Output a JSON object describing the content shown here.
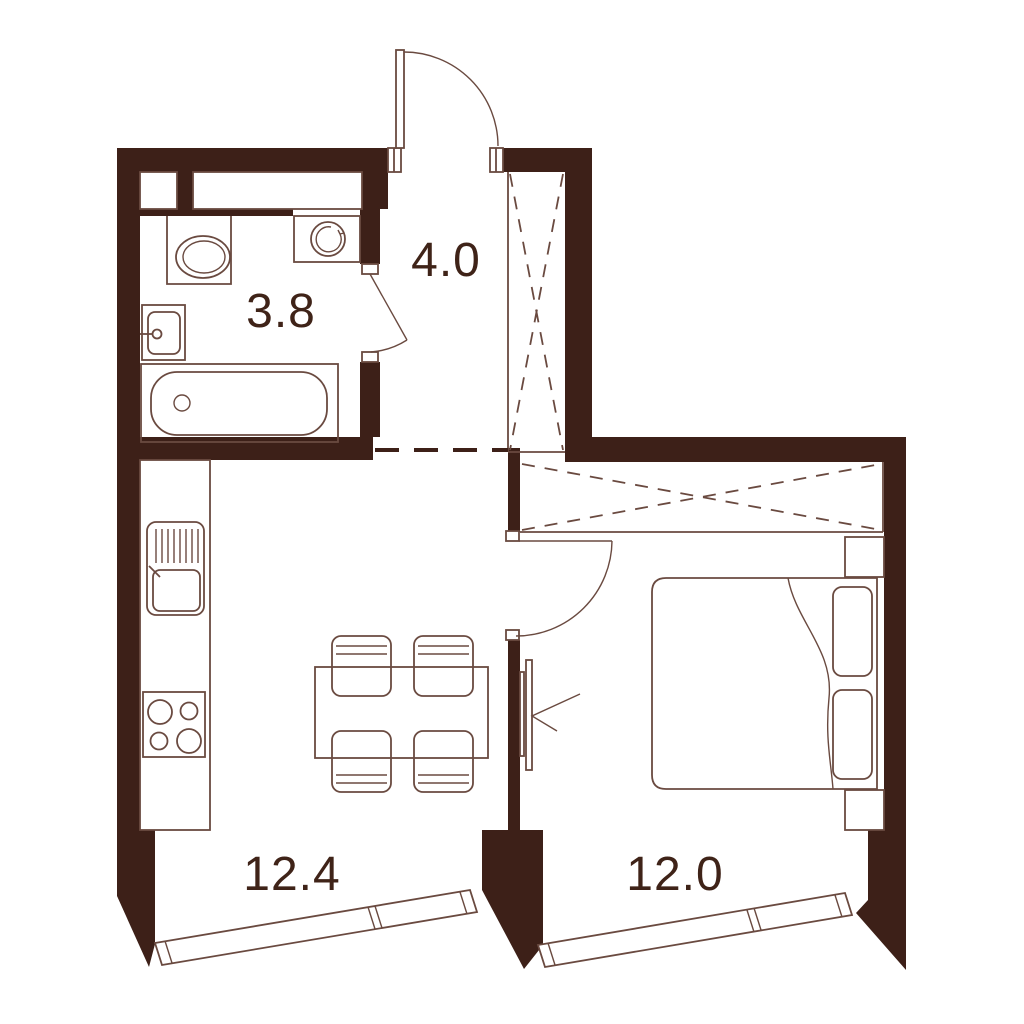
{
  "plan": {
    "title": "apartment-floor-plan",
    "rooms": [
      {
        "id": "bathroom",
        "label": "3.8"
      },
      {
        "id": "hallway",
        "label": "4.0"
      },
      {
        "id": "kitchen-living-room",
        "label": "12.4"
      },
      {
        "id": "bedroom",
        "label": "12.0"
      }
    ],
    "colors": {
      "wall": "#3d2018",
      "line": "#6a4a40",
      "text": "#3f2318",
      "background": "#ffffff"
    }
  }
}
